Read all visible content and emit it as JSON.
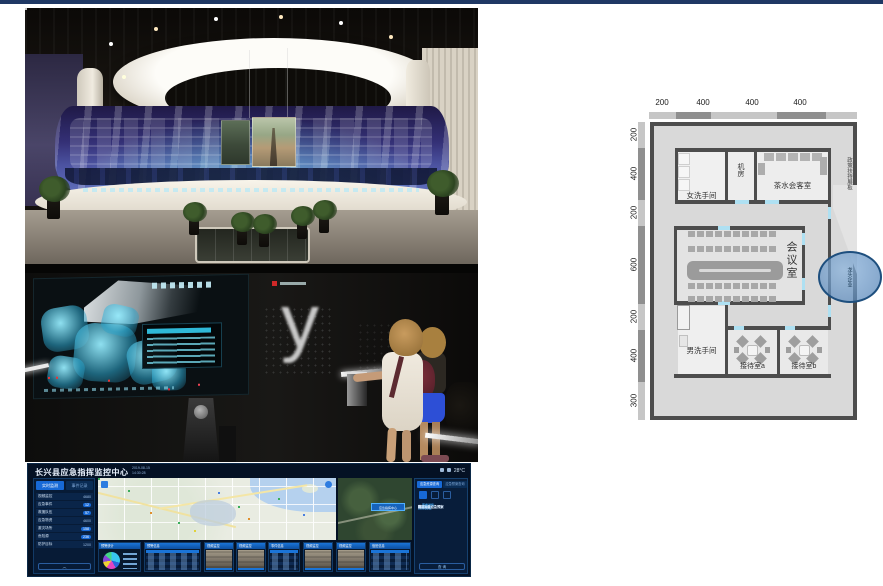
{
  "slide": {
    "accent_color": "#1f3864",
    "background": "#ffffff"
  },
  "photos": {
    "exhibition_hall": "curved video wall exhibition hall",
    "touch_wall": "interactive dark touch wall with visitors",
    "touch_wall_glyph": "y"
  },
  "dashboard": {
    "title": "长兴县应急指挥监控中心",
    "datetime": {
      "line1": "2019-08-15",
      "line2": "14:30:28"
    },
    "temperature": "28°C",
    "sidebar": {
      "tabs": [
        "实时监测",
        "事件记录"
      ],
      "rows": [
        {
          "label": "视频监控",
          "value": "4680",
          "pill": false
        },
        {
          "label": "应急事件",
          "value": "12",
          "pill": true
        },
        {
          "label": "救援队伍",
          "value": "57",
          "pill": true
        },
        {
          "label": "应急物资",
          "value": "4600",
          "pill": false
        },
        {
          "label": "避灾场所",
          "value": "158",
          "pill": true
        },
        {
          "label": "危险源",
          "value": "236",
          "pill": true
        },
        {
          "label": "防护目标",
          "value": "1200",
          "pill": false
        }
      ],
      "footer": "︿"
    },
    "map_label": "长兴县",
    "sat_label": "应急指挥中心",
    "panels": [
      {
        "type": "pie",
        "title": "预警统计"
      },
      {
        "type": "table",
        "title": "预警信息"
      },
      {
        "type": "video",
        "title": "视频监控"
      },
      {
        "type": "video",
        "title": "视频监控"
      },
      {
        "type": "table",
        "title": "事件信息"
      },
      {
        "type": "video",
        "title": "视频监控"
      },
      {
        "type": "video",
        "title": "视频监控"
      },
      {
        "type": "table",
        "title": "值班信息"
      }
    ],
    "pie_colors": [
      "#38c6ef",
      "#2a66dd",
      "#e145c2",
      "#efd335",
      "#8747d8",
      "#43d687"
    ],
    "right_panel": {
      "tabs": [
        "应急资源查询",
        "应急预案查询"
      ],
      "items": [
        {
          "text": "资源类型",
          "kind": "hdr"
        },
        {
          "text": "救援队伍",
          "kind": "item"
        },
        {
          "text": "物资装备",
          "kind": "item"
        },
        {
          "text": "避灾场所",
          "kind": "item"
        },
        {
          "text": "医疗机构",
          "kind": "item"
        },
        {
          "text": "专家库",
          "kind": "item"
        },
        {
          "text": "预案管理",
          "kind": "hdr"
        },
        {
          "text": "防汛防台应急预案",
          "kind": "item"
        },
        {
          "text": "查看详情",
          "kind": "link"
        },
        {
          "text": "地质灾害应急预案",
          "kind": "item"
        },
        {
          "text": "查看详情",
          "kind": "link"
        },
        {
          "text": "森林火灾应急预案",
          "kind": "item"
        }
      ],
      "button": "查 询"
    }
  },
  "floor_plan": {
    "top_dims": [
      "200",
      "400",
      "400",
      "400"
    ],
    "left_dims": [
      "200",
      "400",
      "200",
      "600",
      "200",
      "400",
      "300"
    ],
    "rooms": {
      "women_wc": "女洗手间",
      "server_room": "机房",
      "tea_room": "茶水会客室",
      "policy_board": "政策扶持展板",
      "meeting_room": "会议室",
      "men_wc": "男洗手间",
      "reception_a": "接待室a",
      "reception_b": "接待室b"
    },
    "circle_label": "龙头企业"
  }
}
